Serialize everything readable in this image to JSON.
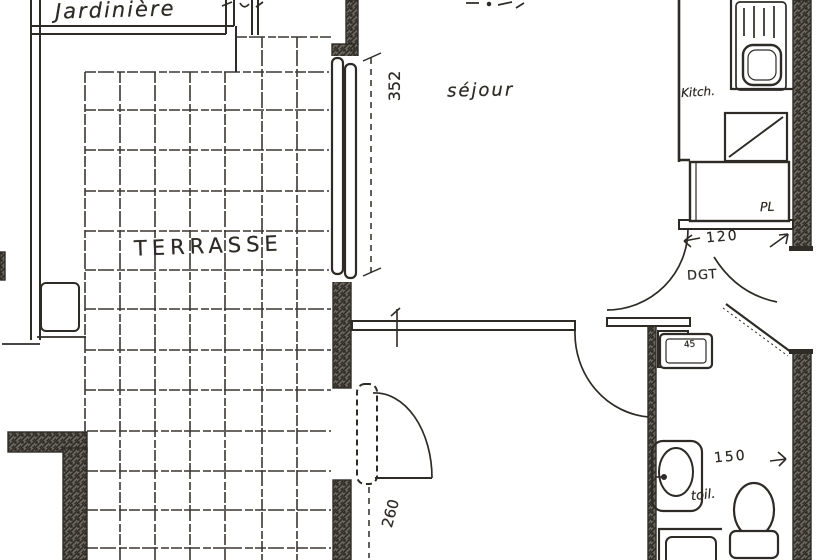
{
  "labels": {
    "planter": "Jardinière",
    "terrace": "TERRASSE",
    "living_room": "séjour",
    "kitchen": "Kitch.",
    "hallway": "DGT",
    "closet": "PL",
    "toilet": "toil."
  },
  "dimensions": {
    "bay_window": "352",
    "terrace_door": "260",
    "hallway_width": "120",
    "toilet_width": "150",
    "niche_width": "45"
  },
  "colors": {
    "ink": "#2e2b27",
    "paper": "#ffffff",
    "wall_fill": "#6b655d",
    "wall_hatch": "#2f2c28"
  }
}
